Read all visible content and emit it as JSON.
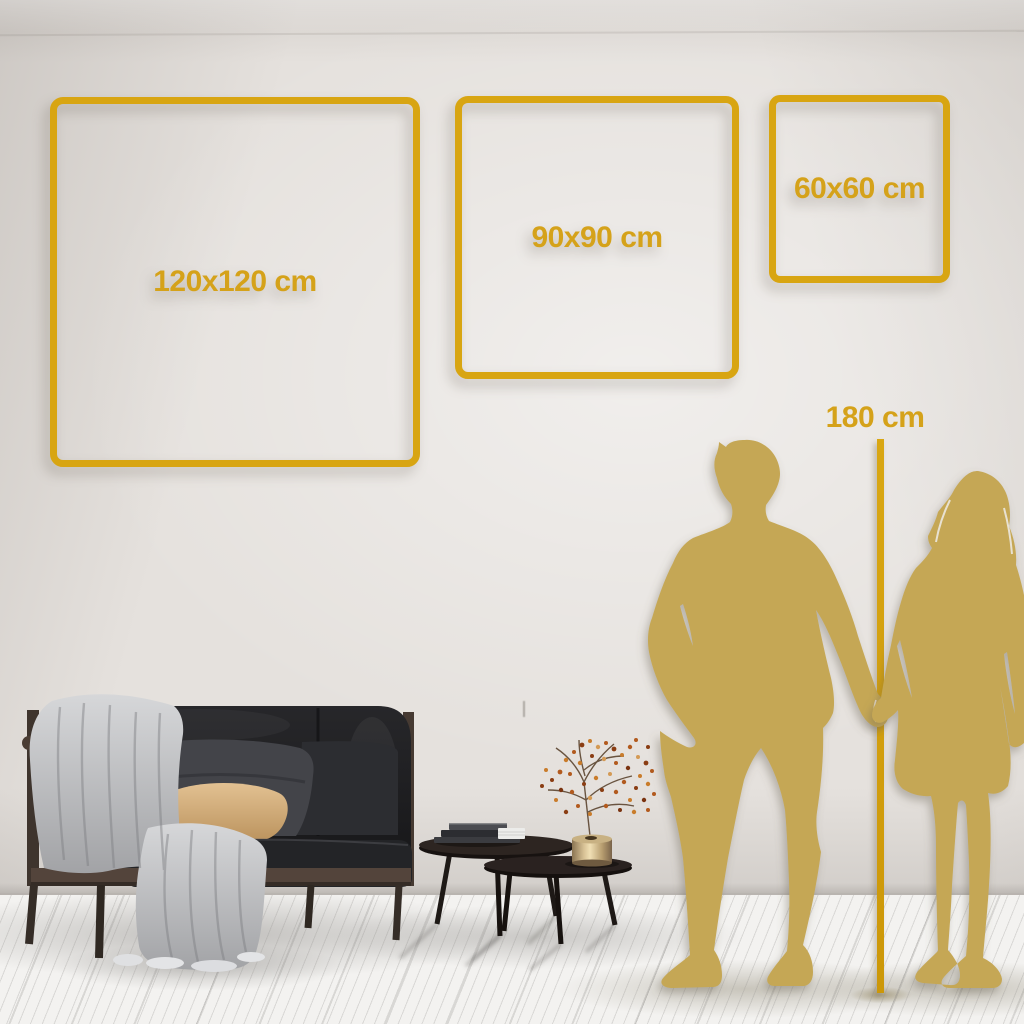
{
  "size_frames": [
    {
      "label": "120x120 cm",
      "width_cm": 120,
      "height_cm": 120
    },
    {
      "label": "90x90 cm",
      "width_cm": 90,
      "height_cm": 90
    },
    {
      "label": "60x60 cm",
      "width_cm": 60,
      "height_cm": 60
    }
  ],
  "height_marker": {
    "label": "180 cm",
    "value_cm": 180
  },
  "colors": {
    "frame_gold": "#d8a512",
    "text_gold": "#d5a21a",
    "ruler_gold": "#d09d0d",
    "silhouette_gold": "#c5a754",
    "wall": "#e5e1dd",
    "floor": "#f3f2f0"
  },
  "scene_objects": [
    "wall",
    "wood-plank-floor",
    "dark-velvet-sofa",
    "throw-blanket",
    "back-cushion",
    "beige-pillow",
    "nesting-coffee-tables",
    "stacked-books",
    "brass-vase",
    "dried-flower-branch",
    "man-silhouette",
    "woman-silhouette",
    "height-ruler-line"
  ]
}
